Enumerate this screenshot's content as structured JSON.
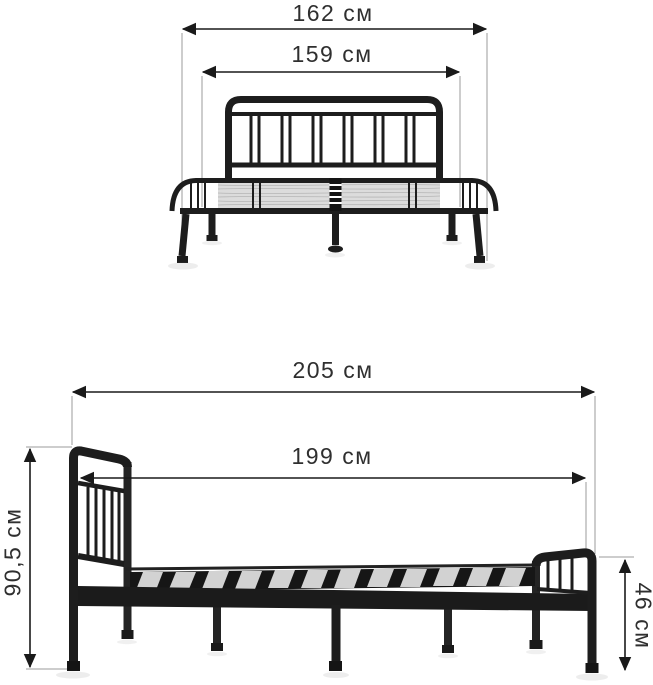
{
  "page": {
    "type": "product-dimension-diagram",
    "product": "metal bed frame",
    "background": "#ffffff"
  },
  "views": {
    "front": {
      "name": "front view",
      "dimensions": {
        "outer_width": {
          "label": "162 см",
          "value": 162,
          "unit": "см",
          "orientation": "horizontal"
        },
        "inner_width": {
          "label": "159 см",
          "value": 159,
          "unit": "см",
          "orientation": "horizontal"
        }
      }
    },
    "side": {
      "name": "side view",
      "dimensions": {
        "outer_length": {
          "label": "205 см",
          "value": 205,
          "unit": "см",
          "orientation": "horizontal"
        },
        "inner_length": {
          "label": "199 см",
          "value": 199,
          "unit": "см",
          "orientation": "horizontal"
        },
        "headboard_height": {
          "label": "90,5 см",
          "value": 90.5,
          "unit": "см",
          "orientation": "vertical"
        },
        "footboard_height": {
          "label": "46 см",
          "value": 46,
          "unit": "см",
          "orientation": "vertical"
        }
      }
    }
  },
  "colors": {
    "frame_black": "#1d1d1d",
    "dimension_line": "#1a1a1a",
    "dimension_text": "#2f2f2f",
    "extension_line": "#9b9b9b",
    "mesh_gray": "#d9d9d9",
    "slat_gray": "#d2d2d2",
    "shadow_gray": "#9a9a9a"
  }
}
